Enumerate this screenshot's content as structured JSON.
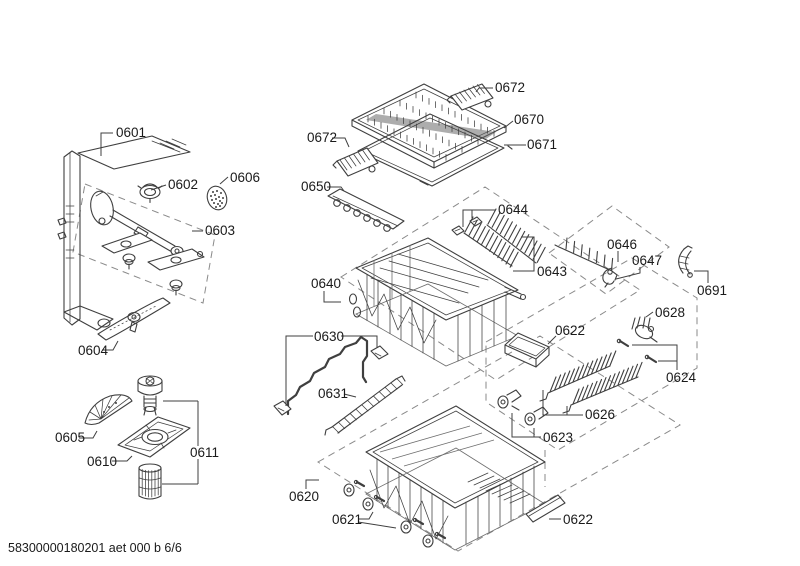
{
  "document": {
    "type": "exploded-parts-diagram",
    "footer_code": "58300000180201 aet 000 b 6/6"
  },
  "colors": {
    "background": "#ffffff",
    "line": "#3f3f3f",
    "label_text": "#1a1a1a",
    "dashed_box": "#8a8a8a"
  },
  "labels": {
    "part_0601": "0601",
    "part_0602": "0602",
    "part_0603": "0603",
    "part_0604": "0604",
    "part_0605": "0605",
    "part_0606": "0606",
    "part_0610": "0610",
    "part_0611": "0611",
    "part_0620": "0620",
    "part_0621": "0621",
    "part_0622_upper": "0622",
    "part_0622_lower": "0622",
    "part_0623": "0623",
    "part_0624": "0624",
    "part_0626": "0626",
    "part_0628": "0628",
    "part_0630": "0630",
    "part_0631": "0631",
    "part_0640": "0640",
    "part_0643": "0643",
    "part_0644": "0644",
    "part_0646": "0646",
    "part_0647": "0647",
    "part_0650": "0650",
    "part_0670": "0670",
    "part_0671": "0671",
    "part_0672_top": "0672",
    "part_0672_left": "0672",
    "part_0691": "0691"
  }
}
